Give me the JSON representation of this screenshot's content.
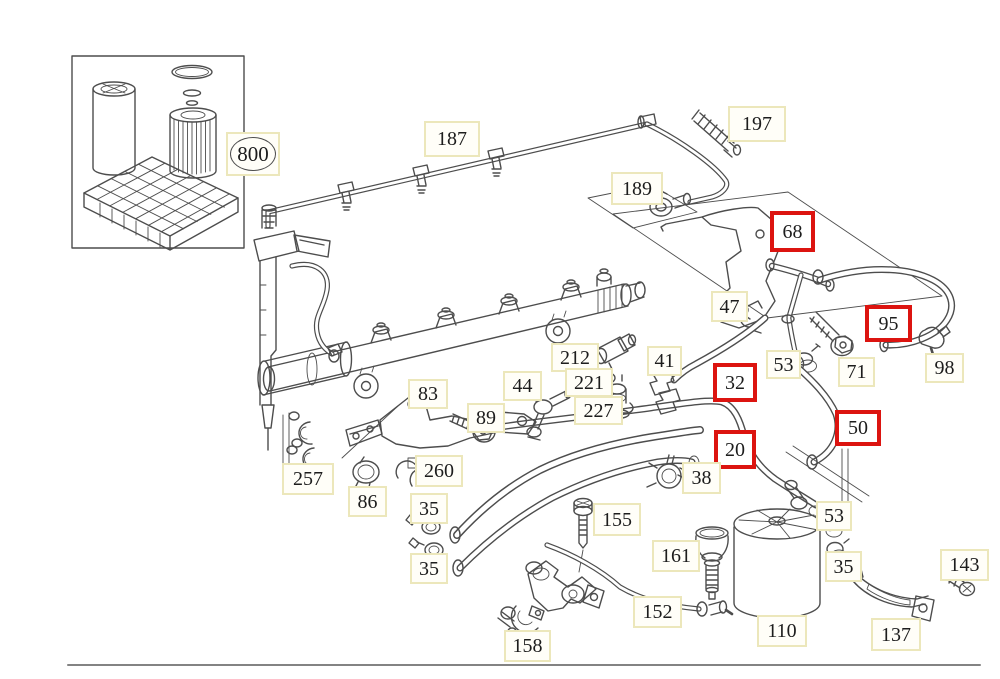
{
  "meta": {
    "type": "parts-diagram",
    "description": "Fuel system / fuel filter line parts diagram with numbered callouts"
  },
  "colors": {
    "background": "#ffffff",
    "line_art": "#4d4d4d",
    "label_border": "#ece7bb",
    "label_background": "#fffef8",
    "highlight_border": "#dc1410",
    "text": "#1d1d1d",
    "baseline": "#838383"
  },
  "highlighted_parts": [
    "68",
    "95",
    "32",
    "20",
    "50"
  ],
  "labels": {
    "p800": "800",
    "p187": "187",
    "p197": "197",
    "p189": "189",
    "p68": "68",
    "p47": "47",
    "p95": "95",
    "p212": "212",
    "p221": "221",
    "p227": "227",
    "p41": "41",
    "p53a": "53",
    "p71": "71",
    "p98": "98",
    "p32": "32",
    "p44": "44",
    "p89": "89",
    "p83": "83",
    "p50": "50",
    "p20": "20",
    "p257": "257",
    "p260": "260",
    "p86": "86",
    "p38": "38",
    "p35a": "35",
    "p35b": "35",
    "p155": "155",
    "p161": "161",
    "p53b": "53",
    "p35c": "35",
    "p152": "152",
    "p158": "158",
    "p110": "110",
    "p137": "137",
    "p143": "143"
  }
}
